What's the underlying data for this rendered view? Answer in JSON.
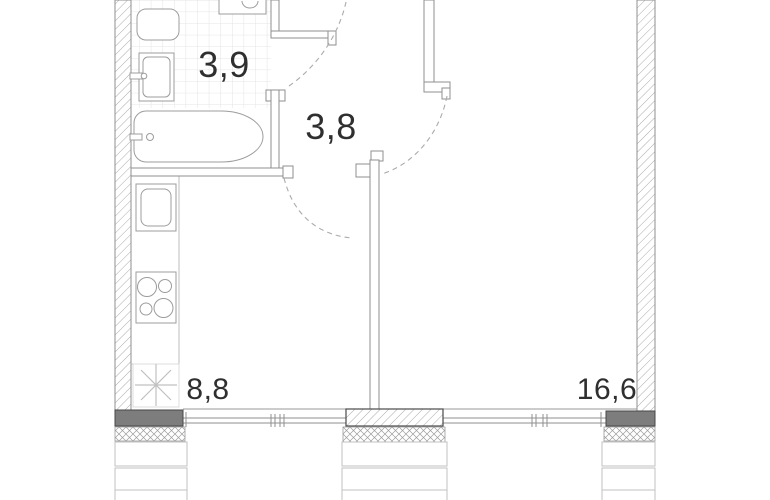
{
  "title": "Apartment floor plan",
  "rooms": [
    {
      "name": "bathroom",
      "area_m2": "3,9"
    },
    {
      "name": "hallway",
      "area_m2": "3,8"
    },
    {
      "name": "kitchen-living",
      "area_m2": "8,8"
    },
    {
      "name": "living-room",
      "area_m2": "16,6"
    }
  ],
  "symbols": {
    "refrigerator": "snowflake-asterisk",
    "fixtures": [
      "toilet",
      "washing-machine",
      "sink",
      "bathtub",
      "kitchen-sink",
      "stove-4-burners"
    ],
    "doors": [
      "bathroom-door-arc",
      "kitchen-door-arc",
      "living-room-door-arc"
    ]
  },
  "colors": {
    "background": "#ffffff",
    "wall_line": "#8f8f8f",
    "dark_wall_fill": "#7d7d7d",
    "hatch_line": "#ababab",
    "tile_grid": "#e4e4e4",
    "label_text": "#2f2f2f",
    "door_arc": "#ababab",
    "symbol_gray": "#c0c0c0"
  }
}
